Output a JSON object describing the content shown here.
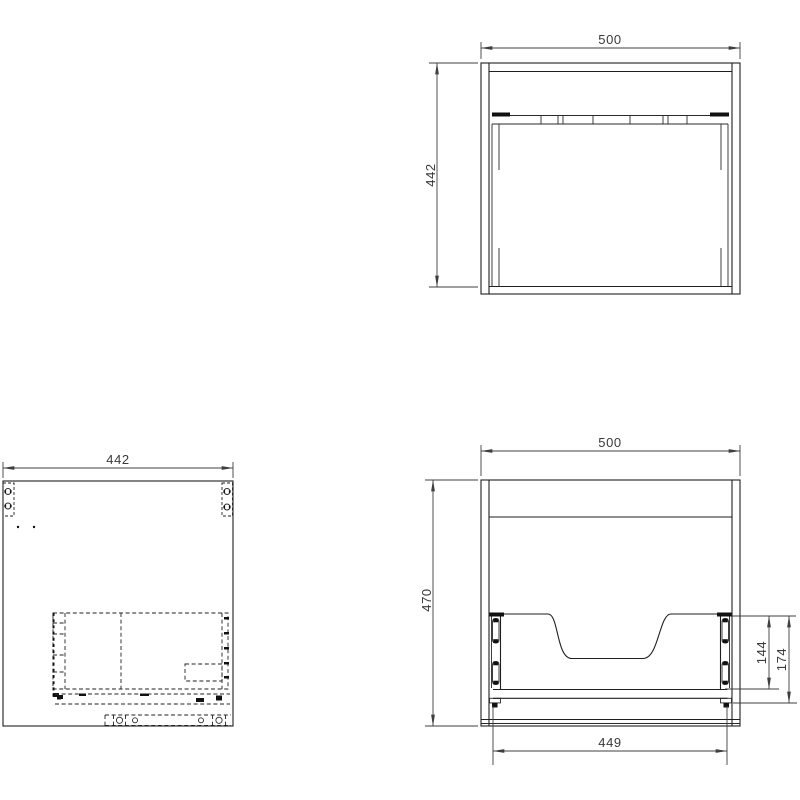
{
  "drawing": {
    "background": "#ffffff",
    "line_color": "#1f1f1f",
    "dimension_color": "#3f3f3f",
    "views": {
      "top": {
        "width_label": "500",
        "depth_label": "442"
      },
      "side": {
        "depth_label": "442"
      },
      "rear": {
        "width_label": "500",
        "height_label": "470",
        "drawer_width_label": "449",
        "slide_height_label": "144",
        "rail_height_label": "174"
      }
    }
  }
}
